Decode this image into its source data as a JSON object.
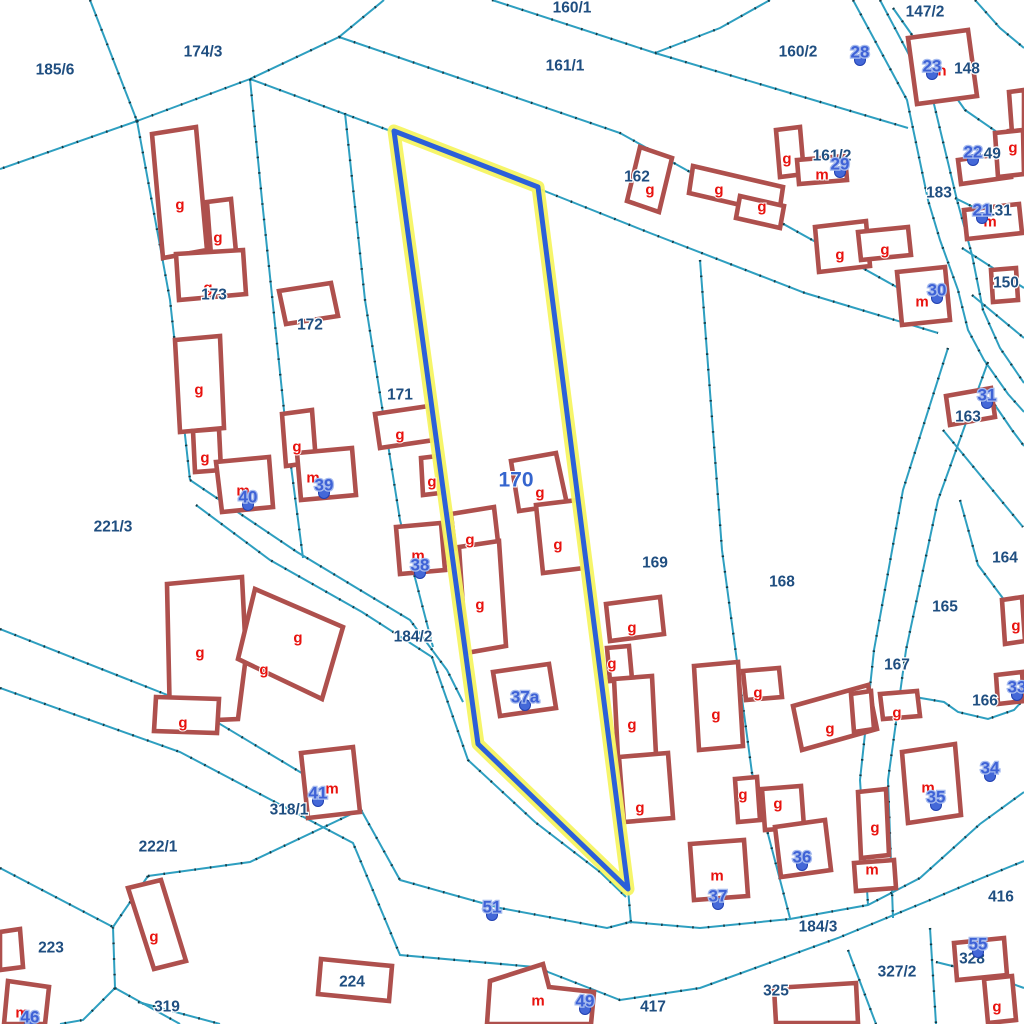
{
  "map": {
    "colors": {
      "background": "#ffffff",
      "boundary_line": "#2e9fc0",
      "boundary_dots": "#123a46",
      "building_outline": "#ae504d",
      "parcel_label": "#1f4e80",
      "building_letter": "#e8120e",
      "house_number": "#3e62d6",
      "house_number_halo": "#a6bbee",
      "highlight_halo": "#f5f462",
      "highlight_line": "#2b5fd9",
      "selected_parcel_label": "#3565ce"
    },
    "selected_parcel": {
      "label": "170",
      "x": 516,
      "y": 480
    },
    "highlight_polygon": "394,131 538,187 628,889 478,744",
    "boundaries": [
      "90,0 137,121",
      "137,121 0,169",
      "137,121 250,79 339,37 384,0",
      "492,0 655,53 908,128",
      "655,53 720,28 770,0",
      "339,37 415,63 620,133 920,300 935,318",
      "250,79 388,130 537,188 650,233 805,293 938,333",
      "250,79 262,200 285,420 303,558",
      "345,113 365,300 400,520 433,647",
      "137,121 170,300 190,480",
      "190,480 297,552 360,590 410,620 447,670 463,702",
      "196,505 270,560 362,612 432,657 468,760 535,822 600,872 626,897",
      "700,260 722,550 752,773 790,918",
      "948,348 903,490 874,650 860,780 868,905",
      "988,362 938,500 906,650 888,780 893,918",
      "853,0 907,100 928,200 940,240 958,290 968,330 984,360 1008,394 1024,412",
      "880,0 933,100 957,200 972,255 983,310 1000,348 1024,383",
      "975,0 1000,28 1024,48",
      "893,8 965,110 1023,150",
      "955,198 1024,232",
      "962,248 1024,288",
      "972,295 1024,338",
      "986,392 1012,430 1024,446",
      "943,430 1023,527",
      "960,500 978,565 1008,605 1024,617",
      "903,695 944,702 958,712 988,719 1014,710 1024,699",
      "0,629 180,700 360,808 400,880 500,908 607,928 630,922",
      "0,688 180,752 353,843 400,955 535,967 620,1000 700,988 838,938 930,900 982,878 1024,861",
      "630,922 700,928 790,919 868,905 920,878 980,824 1024,792",
      "628,889 631,923",
      "0,868 113,927",
      "113,927 115,988",
      "148,876 113,927",
      "148,876 250,862 360,810",
      "115,988 180,1024",
      "138,1002 220,1024",
      "115,988 83,1020 60,1024",
      "848,950 876,1024",
      "930,928 936,1024",
      "936,962 985,974 1024,988"
    ],
    "buildings": [
      "152,134 196,127 207,250 163,258",
      "207,202 231,199 236,252 211,255",
      "176,254 243,250 246,294 179,300",
      "279,291 331,283 338,316 286,324",
      "375,414 429,406 434,440 380,448",
      "421,458 438,456 440,493 423,495",
      "175,340 220,336 224,428 180,432",
      "193,431 219,429 221,470 195,472",
      "216,462 269,457 273,507 222,512",
      "282,414 312,410 316,462 286,466",
      "297,453 352,448 356,495 301,500",
      "396,527 441,523 445,570 400,574",
      "511,461 556,453 567,504 519,511",
      "536,505 578,500 584,568 543,573",
      "451,514 494,507 498,542 455,549",
      "459,547 499,541 506,646 466,653",
      "493,672 549,664 556,708 500,716",
      "606,604 660,597 664,634 610,641",
      "607,648 629,646 632,679 610,681",
      "614,679 652,676 656,755 618,758",
      "619,757 668,753 673,818 624,822",
      "694,666 738,662 743,746 699,750",
      "743,671 779,668 782,697 746,700",
      "793,706 868,685 877,729 802,750",
      "880,694 917,691 920,716 883,719",
      "735,779 757,777 760,820 738,822",
      "762,789 801,786 804,827 765,830",
      "775,827 825,820 831,870 781,877",
      "690,844 744,840 748,896 694,900",
      "902,752 955,744 961,815 908,823",
      "858,792 886,789 889,855 861,858",
      "854,863 894,860 896,888 856,891",
      "897,272 945,267 950,320 902,325",
      "991,270 1016,268 1018,300 993,302",
      "946,396 991,388 995,417 950,425",
      "908,38 968,30 977,96 917,104",
      "958,160 1008,153 1011,177 961,184",
      "1009,131 1023,129 1024,156 1011,158",
      "964,210 1019,204 1022,233 967,239",
      "776,130 800,127 804,174 780,177",
      "797,160 845,156 847,180 799,184",
      "693,166 783,187 779,214 689,193",
      "740,196 784,206 780,228 736,218",
      "640,147 672,158 659,212 627,201",
      "815,227 866,221 870,266 819,272",
      "858,232 908,227 911,255 861,260",
      "1009,92 1024,90 1024,131 1012,133",
      "995,133 1023,130 1024,174 998,177",
      "167,584 242,577 246,656 238,719 170,722",
      "255,589 343,627 322,699 238,659",
      "156,697 219,699 217,733 154,731",
      "301,753 353,747 360,812 308,818",
      "128,888 161,880 186,961 154,969",
      "321,959 392,966 389,1001 318,994",
      "8,981 49,987 45,1024 4,1024",
      "0,932 20,929 23,967 0,970",
      "490,981 543,964 549,987 594,992 591,1024 487,1024",
      "954,943 1004,938 1007,975 957,980",
      "984,979 1012,976 1016,1020 988,1023",
      "774,988 856,983 858,1023 776,1023",
      "1002,600 1022,597 1025,641 1005,644",
      "996,675 1022,672 1024,701 998,704",
      "851,694 871,691 874,729 854,732"
    ],
    "parcel_labels": [
      {
        "t": "185/6",
        "x": 55,
        "y": 70
      },
      {
        "t": "174/3",
        "x": 203,
        "y": 52
      },
      {
        "t": "160/1",
        "x": 572,
        "y": 8
      },
      {
        "t": "161/1",
        "x": 565,
        "y": 66
      },
      {
        "t": "147/2",
        "x": 925,
        "y": 12
      },
      {
        "t": "160/2",
        "x": 798,
        "y": 52
      },
      {
        "t": "148",
        "x": 967,
        "y": 69
      },
      {
        "t": "149",
        "x": 988,
        "y": 154
      },
      {
        "t": "161/2",
        "x": 832,
        "y": 156
      },
      {
        "t": "183",
        "x": 939,
        "y": 193
      },
      {
        "t": "131",
        "x": 999,
        "y": 211
      },
      {
        "t": "150",
        "x": 1006,
        "y": 283
      },
      {
        "t": "162",
        "x": 637,
        "y": 177
      },
      {
        "t": "163",
        "x": 968,
        "y": 417
      },
      {
        "t": "164",
        "x": 1005,
        "y": 558
      },
      {
        "t": "165",
        "x": 945,
        "y": 607
      },
      {
        "t": "166",
        "x": 985,
        "y": 701
      },
      {
        "t": "167",
        "x": 897,
        "y": 665
      },
      {
        "t": "168",
        "x": 782,
        "y": 582
      },
      {
        "t": "169",
        "x": 655,
        "y": 563
      },
      {
        "t": "171",
        "x": 400,
        "y": 395
      },
      {
        "t": "172",
        "x": 310,
        "y": 325
      },
      {
        "t": "173",
        "x": 214,
        "y": 295
      },
      {
        "t": "221/3",
        "x": 113,
        "y": 527
      },
      {
        "t": "184/2",
        "x": 413,
        "y": 637
      },
      {
        "t": "318/1",
        "x": 289,
        "y": 810
      },
      {
        "t": "222/1",
        "x": 158,
        "y": 847
      },
      {
        "t": "223",
        "x": 51,
        "y": 948
      },
      {
        "t": "319",
        "x": 167,
        "y": 1007
      },
      {
        "t": "224",
        "x": 352,
        "y": 982
      },
      {
        "t": "184/3",
        "x": 818,
        "y": 927
      },
      {
        "t": "417",
        "x": 653,
        "y": 1007
      },
      {
        "t": "416",
        "x": 1001,
        "y": 897
      },
      {
        "t": "325",
        "x": 776,
        "y": 991
      },
      {
        "t": "327/2",
        "x": 897,
        "y": 972
      },
      {
        "t": "328",
        "x": 972,
        "y": 959
      }
    ],
    "building_letters": [
      {
        "t": "g",
        "x": 180,
        "y": 205
      },
      {
        "t": "g",
        "x": 218,
        "y": 238
      },
      {
        "t": "g",
        "x": 208,
        "y": 288
      },
      {
        "t": "g",
        "x": 199,
        "y": 390
      },
      {
        "t": "g",
        "x": 205,
        "y": 458
      },
      {
        "t": "m",
        "x": 243,
        "y": 491
      },
      {
        "t": "g",
        "x": 297,
        "y": 447
      },
      {
        "t": "m",
        "x": 313,
        "y": 478
      },
      {
        "t": "g",
        "x": 400,
        "y": 435
      },
      {
        "t": "g",
        "x": 432,
        "y": 482
      },
      {
        "t": "m",
        "x": 418,
        "y": 556
      },
      {
        "t": "g",
        "x": 470,
        "y": 540
      },
      {
        "t": "g",
        "x": 480,
        "y": 605
      },
      {
        "t": "g",
        "x": 540,
        "y": 493
      },
      {
        "t": "g",
        "x": 558,
        "y": 545
      },
      {
        "t": "g",
        "x": 650,
        "y": 190
      },
      {
        "t": "g",
        "x": 719,
        "y": 190
      },
      {
        "t": "g",
        "x": 762,
        "y": 207
      },
      {
        "t": "g",
        "x": 787,
        "y": 159
      },
      {
        "t": "m",
        "x": 822,
        "y": 175
      },
      {
        "t": "g",
        "x": 840,
        "y": 255
      },
      {
        "t": "g",
        "x": 885,
        "y": 250
      },
      {
        "t": "n",
        "x": 942,
        "y": 71
      },
      {
        "t": "g",
        "x": 1013,
        "y": 148
      },
      {
        "t": "m",
        "x": 990,
        "y": 222
      },
      {
        "t": "m",
        "x": 922,
        "y": 302
      },
      {
        "t": "g",
        "x": 1016,
        "y": 626
      },
      {
        "t": "g",
        "x": 897,
        "y": 713
      },
      {
        "t": "g",
        "x": 632,
        "y": 628
      },
      {
        "t": "g",
        "x": 612,
        "y": 664
      },
      {
        "t": "g",
        "x": 632,
        "y": 725
      },
      {
        "t": "g",
        "x": 640,
        "y": 808
      },
      {
        "t": "g",
        "x": 716,
        "y": 715
      },
      {
        "t": "g",
        "x": 758,
        "y": 693
      },
      {
        "t": "g",
        "x": 830,
        "y": 729
      },
      {
        "t": "g",
        "x": 743,
        "y": 795
      },
      {
        "t": "g",
        "x": 778,
        "y": 804
      },
      {
        "t": "g",
        "x": 875,
        "y": 828
      },
      {
        "t": "m",
        "x": 872,
        "y": 870
      },
      {
        "t": "m",
        "x": 928,
        "y": 788
      },
      {
        "t": "g",
        "x": 200,
        "y": 653
      },
      {
        "t": "g",
        "x": 298,
        "y": 638
      },
      {
        "t": "g",
        "x": 264,
        "y": 670
      },
      {
        "t": "g",
        "x": 183,
        "y": 723
      },
      {
        "t": "m",
        "x": 332,
        "y": 789
      },
      {
        "t": "g",
        "x": 154,
        "y": 937
      },
      {
        "t": "m",
        "x": 22,
        "y": 1013
      },
      {
        "t": "m",
        "x": 538,
        "y": 1001
      },
      {
        "t": "m",
        "x": 717,
        "y": 876
      },
      {
        "t": "g",
        "x": 997,
        "y": 1007
      }
    ],
    "house_numbers": [
      {
        "t": "28",
        "x": 860,
        "y": 52
      },
      {
        "t": "23",
        "x": 932,
        "y": 66
      },
      {
        "t": "22",
        "x": 973,
        "y": 152
      },
      {
        "t": "29",
        "x": 840,
        "y": 164
      },
      {
        "t": "21",
        "x": 982,
        "y": 210
      },
      {
        "t": "30",
        "x": 937,
        "y": 290
      },
      {
        "t": "31",
        "x": 987,
        "y": 395
      },
      {
        "t": "40",
        "x": 248,
        "y": 497
      },
      {
        "t": "39",
        "x": 324,
        "y": 485
      },
      {
        "t": "38",
        "x": 420,
        "y": 565
      },
      {
        "t": "33",
        "x": 1017,
        "y": 687
      },
      {
        "t": "34",
        "x": 990,
        "y": 768
      },
      {
        "t": "35",
        "x": 936,
        "y": 797
      },
      {
        "t": "41",
        "x": 318,
        "y": 793
      },
      {
        "t": "36",
        "x": 802,
        "y": 857
      },
      {
        "t": "37",
        "x": 718,
        "y": 896
      },
      {
        "t": "51",
        "x": 492,
        "y": 907
      },
      {
        "t": "37a",
        "x": 525,
        "y": 697
      },
      {
        "t": "46",
        "x": 30,
        "y": 1017
      },
      {
        "t": "49",
        "x": 585,
        "y": 1001
      },
      {
        "t": "55",
        "x": 978,
        "y": 944
      }
    ]
  }
}
